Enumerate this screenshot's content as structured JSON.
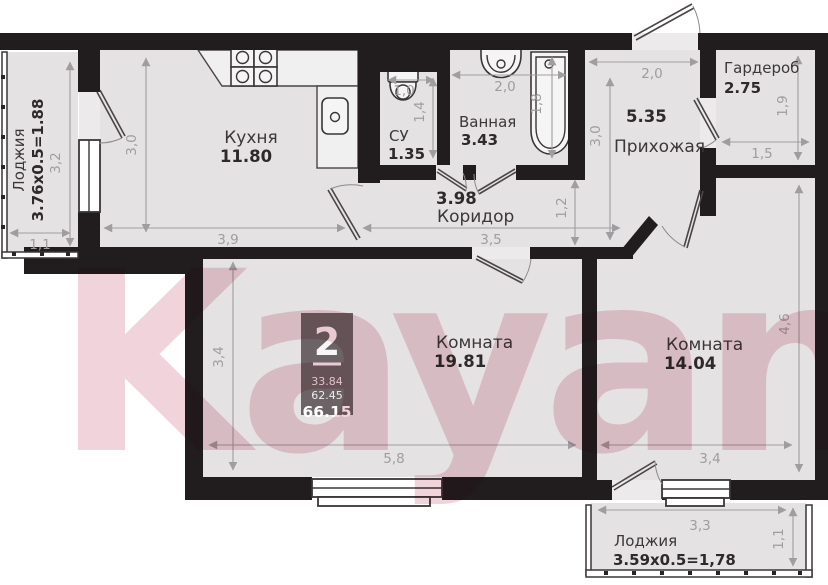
{
  "watermark": {
    "text": "Kayan"
  },
  "unit_badge": {
    "rooms": "2",
    "area_living": "33.84",
    "area_main": "62.45",
    "area_total": "66.15"
  },
  "rooms": {
    "loggia_left": {
      "name": "Лоджия",
      "area": "3.76x0.5=1.88"
    },
    "kitchen": {
      "name": "Кухня",
      "area": "11.80"
    },
    "wc": {
      "name": "СУ",
      "area": "1.35"
    },
    "bath": {
      "name": "Ванная",
      "area": "3.43"
    },
    "hall": {
      "name": "Прихожая",
      "area": "5.35"
    },
    "wardrobe": {
      "name": "Гардероб",
      "area": "2.75"
    },
    "corridor": {
      "name": "Коридор",
      "area": "3.98"
    },
    "room1": {
      "name": "Комната",
      "area": "19.81"
    },
    "room2": {
      "name": "Комната",
      "area": "14.04"
    },
    "loggia_bottom": {
      "name": "Лоджия",
      "area": "3.59x0.5=1,78"
    }
  },
  "dims": {
    "loggia_left_h": "3,2",
    "loggia_left_w": "1,1",
    "kitchen_h": "3,0",
    "kitchen_w": "3,9",
    "wc_w": "1,0",
    "wc_h": "1,4",
    "bath_w": "2,0",
    "bath_h": "1,8",
    "hall_w": "2,0",
    "hall_h": "3,0",
    "wardrobe_h": "1,9",
    "wardrobe_w": "1,5",
    "corridor_h": "1,2",
    "corridor_w": "3,5",
    "room1_h": "3,4",
    "room1_w": "5,8",
    "room2_h": "4,6",
    "room2_w": "3,4",
    "loggia_bottom_w": "3,3",
    "loggia_bottom_h": "1,1"
  },
  "colors": {
    "wall": "#211d1e",
    "floor": "#e4e2e3",
    "watermark_pink": "#d98aa0",
    "dim_gray": "#a09da0"
  }
}
